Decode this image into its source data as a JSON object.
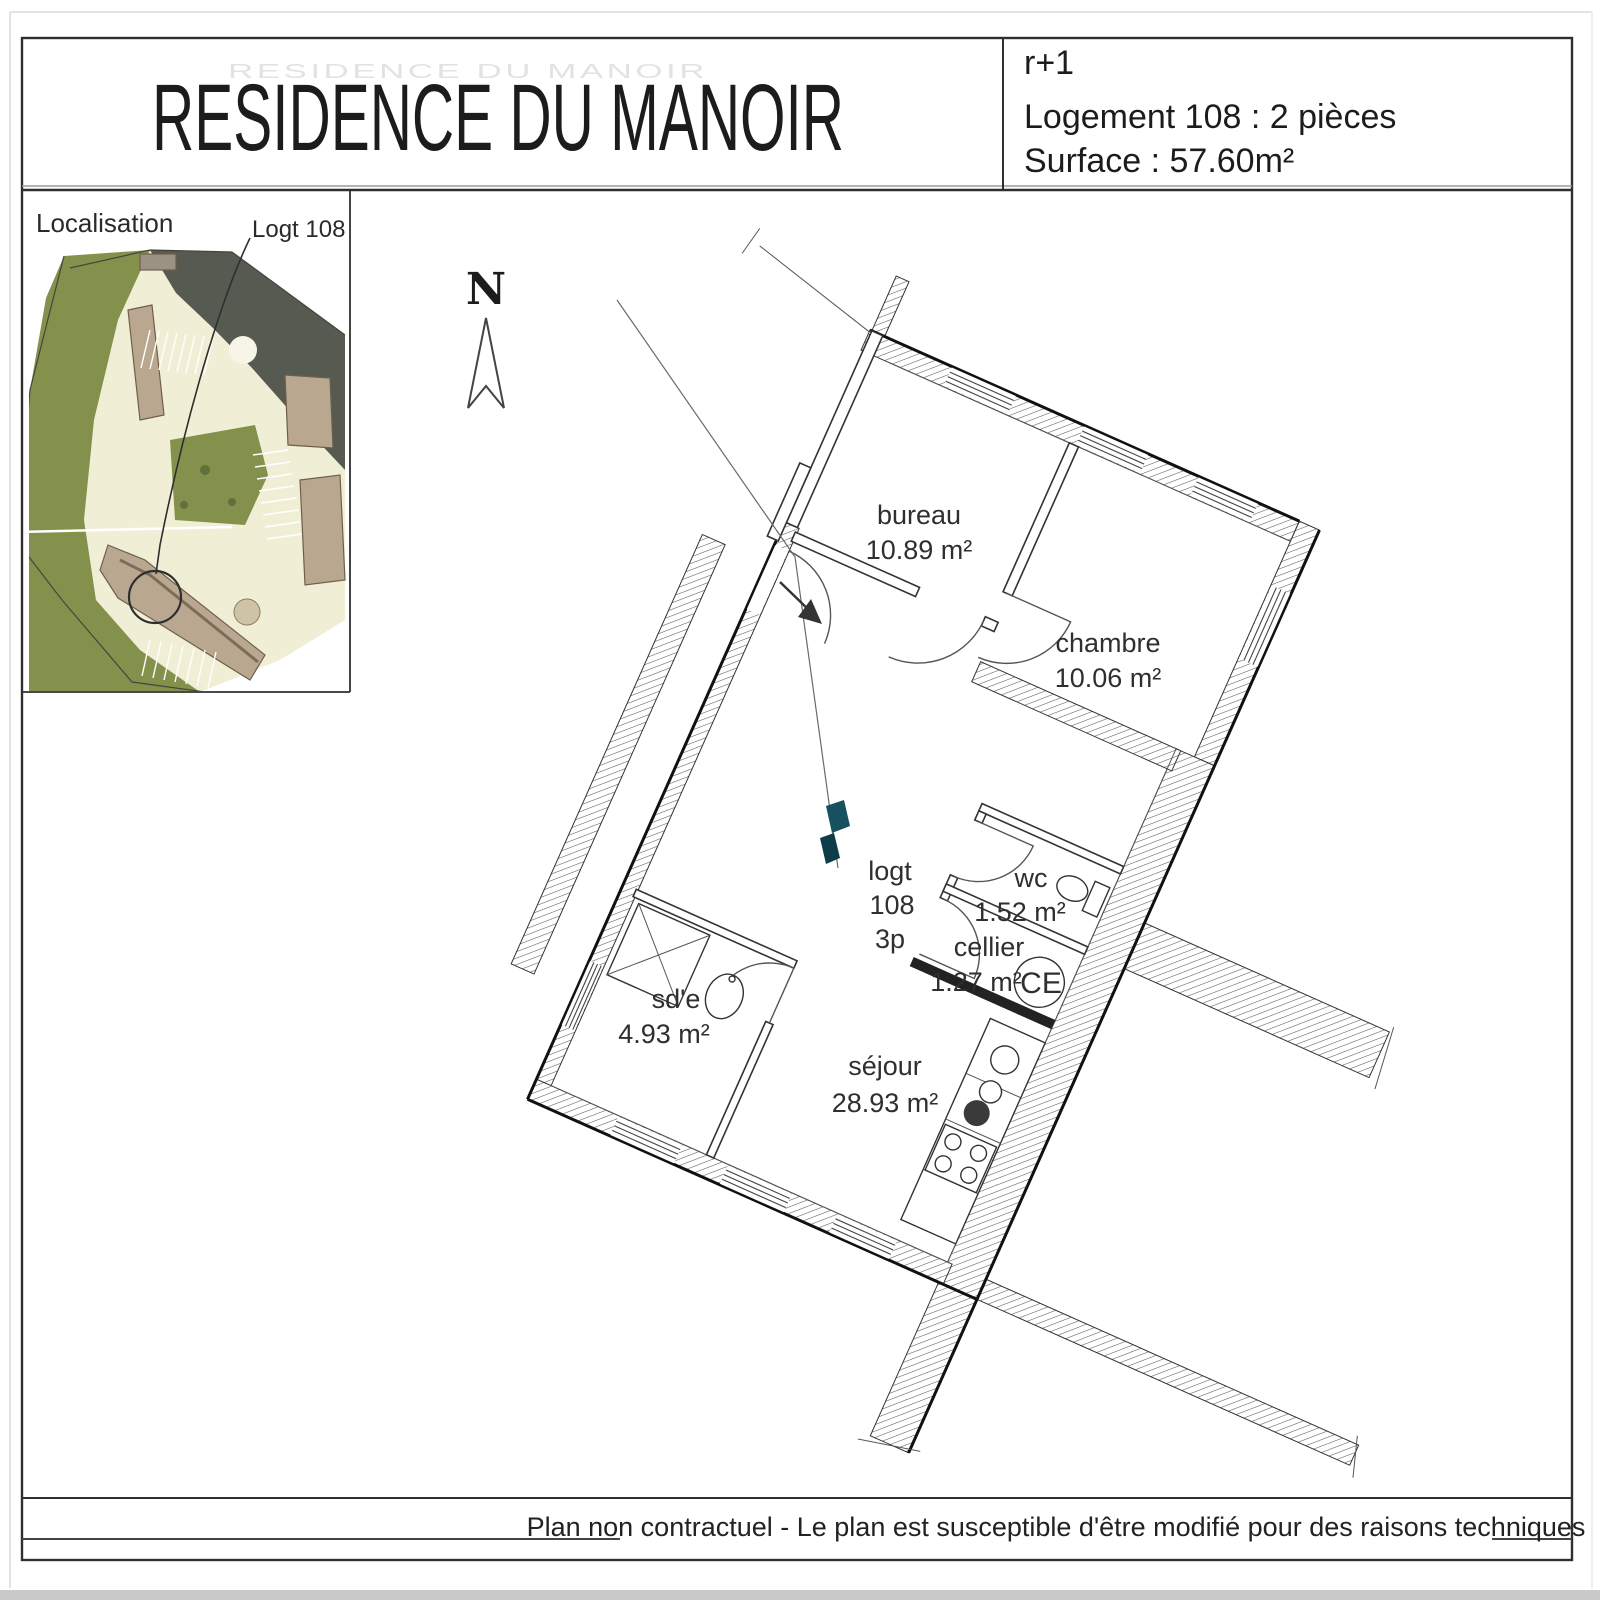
{
  "header": {
    "title": "RESIDENCE DU MANOIR",
    "floor": "r+1",
    "unit": "Logement 108 : 2 pièces",
    "surface": "Surface : 57.60m²"
  },
  "localisation": {
    "label": "Localisation",
    "marker_label": "Logt 108"
  },
  "compass": {
    "north": "N"
  },
  "plan": {
    "unit_tag": {
      "line1": "logt",
      "line2": "108",
      "line3": "3p"
    },
    "rooms": [
      {
        "name": "bureau",
        "area": "10.89 m²"
      },
      {
        "name": "chambre",
        "area": "10.06 m²"
      },
      {
        "name": "wc",
        "area": "1.52 m²"
      },
      {
        "name": "cellier",
        "area": "1.27 m²"
      },
      {
        "name": "sd'e",
        "area": "4.93 m²"
      },
      {
        "name": "séjour",
        "area": "28.93 m²"
      }
    ],
    "water_heater": "CE"
  },
  "footer": {
    "disclaimer": "Plan non contractuel - Le plan est susceptible d'être modifié pour des raisons techniques"
  },
  "colors": {
    "site_green": "#84914d",
    "site_road": "#f1eed6",
    "site_roof": "#565a50",
    "site_building": "#b9a88f",
    "door_accent_teal": "#17505e"
  }
}
